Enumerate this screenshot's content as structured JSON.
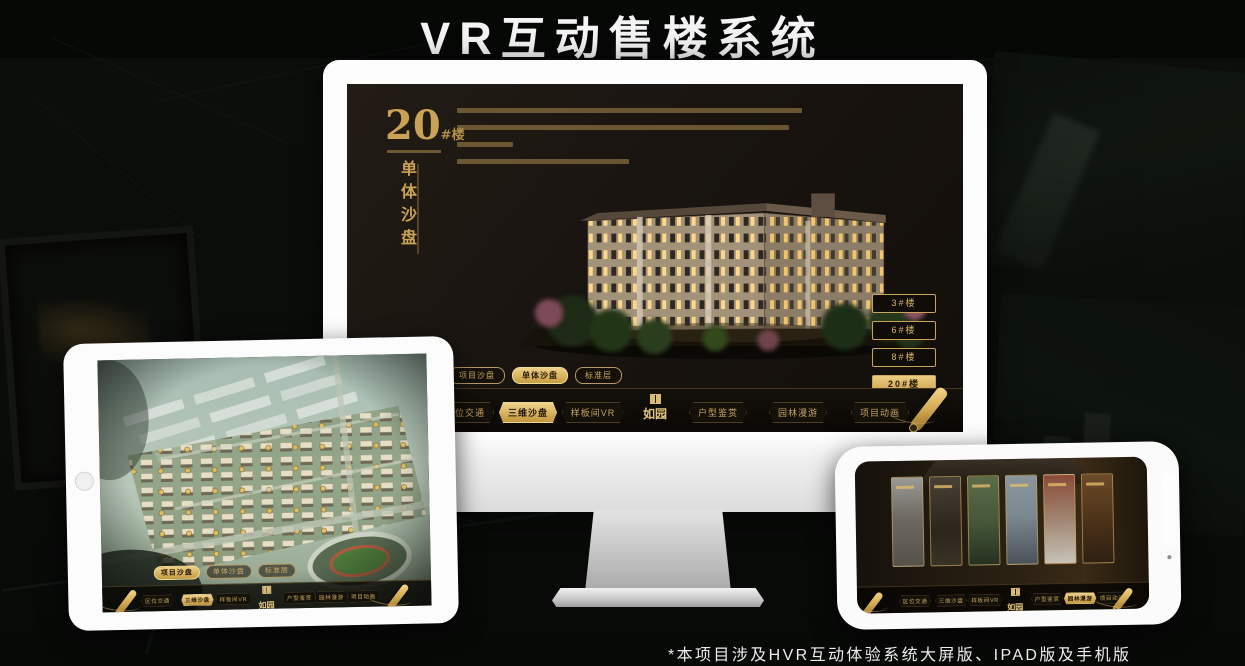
{
  "page": {
    "title": "VR互动售楼系统",
    "footnote": "*本项目涉及HVR互动体验系统大屏版、IPAD版及手机版"
  },
  "colors": {
    "gold": "#c9a45c",
    "gold_bright": "#eccd82",
    "screen_bg": "#1a1410",
    "title_text": "#f4f4f4"
  },
  "monitor": {
    "hero": {
      "number": "20",
      "suffix": "#楼",
      "name": "单体沙盘"
    },
    "sub_tabs": [
      {
        "label": "项目沙盘",
        "active": false
      },
      {
        "label": "单体沙盘",
        "active": true
      },
      {
        "label": "标准层",
        "active": false
      }
    ],
    "floor_buttons": [
      {
        "label": "3#楼",
        "active": false
      },
      {
        "label": "6#楼",
        "active": false
      },
      {
        "label": "8#楼",
        "active": false
      },
      {
        "label": "20#楼",
        "active": true
      }
    ],
    "nav": [
      {
        "label": "区位交通",
        "active": false
      },
      {
        "label": "三维沙盘",
        "active": true
      },
      {
        "label": "样板间VR",
        "active": false
      },
      {
        "label": "户型鉴赏",
        "active": false
      },
      {
        "label": "园林漫游",
        "active": false
      },
      {
        "label": "项目动画",
        "active": false
      }
    ],
    "logo": "如园"
  },
  "tablet": {
    "sub_tabs": [
      {
        "label": "项目沙盘",
        "active": true
      },
      {
        "label": "单体沙盘",
        "active": false
      },
      {
        "label": "标准层",
        "active": false
      }
    ],
    "nav": [
      {
        "label": "区位交通",
        "active": false
      },
      {
        "label": "三维沙盘",
        "active": true
      },
      {
        "label": "样板间VR",
        "active": false
      },
      {
        "label": "户型鉴赏",
        "active": false
      },
      {
        "label": "园林漫游",
        "active": false
      },
      {
        "label": "项目动画",
        "active": false
      }
    ],
    "logo": "如园"
  },
  "phone": {
    "nav": [
      {
        "label": "区位交通",
        "active": false
      },
      {
        "label": "三维沙盘",
        "active": false
      },
      {
        "label": "样板间VR",
        "active": false
      },
      {
        "label": "户型鉴赏",
        "active": false
      },
      {
        "label": "园林漫游",
        "active": true
      },
      {
        "label": "项目动画",
        "active": false
      }
    ],
    "logo": "如园"
  }
}
